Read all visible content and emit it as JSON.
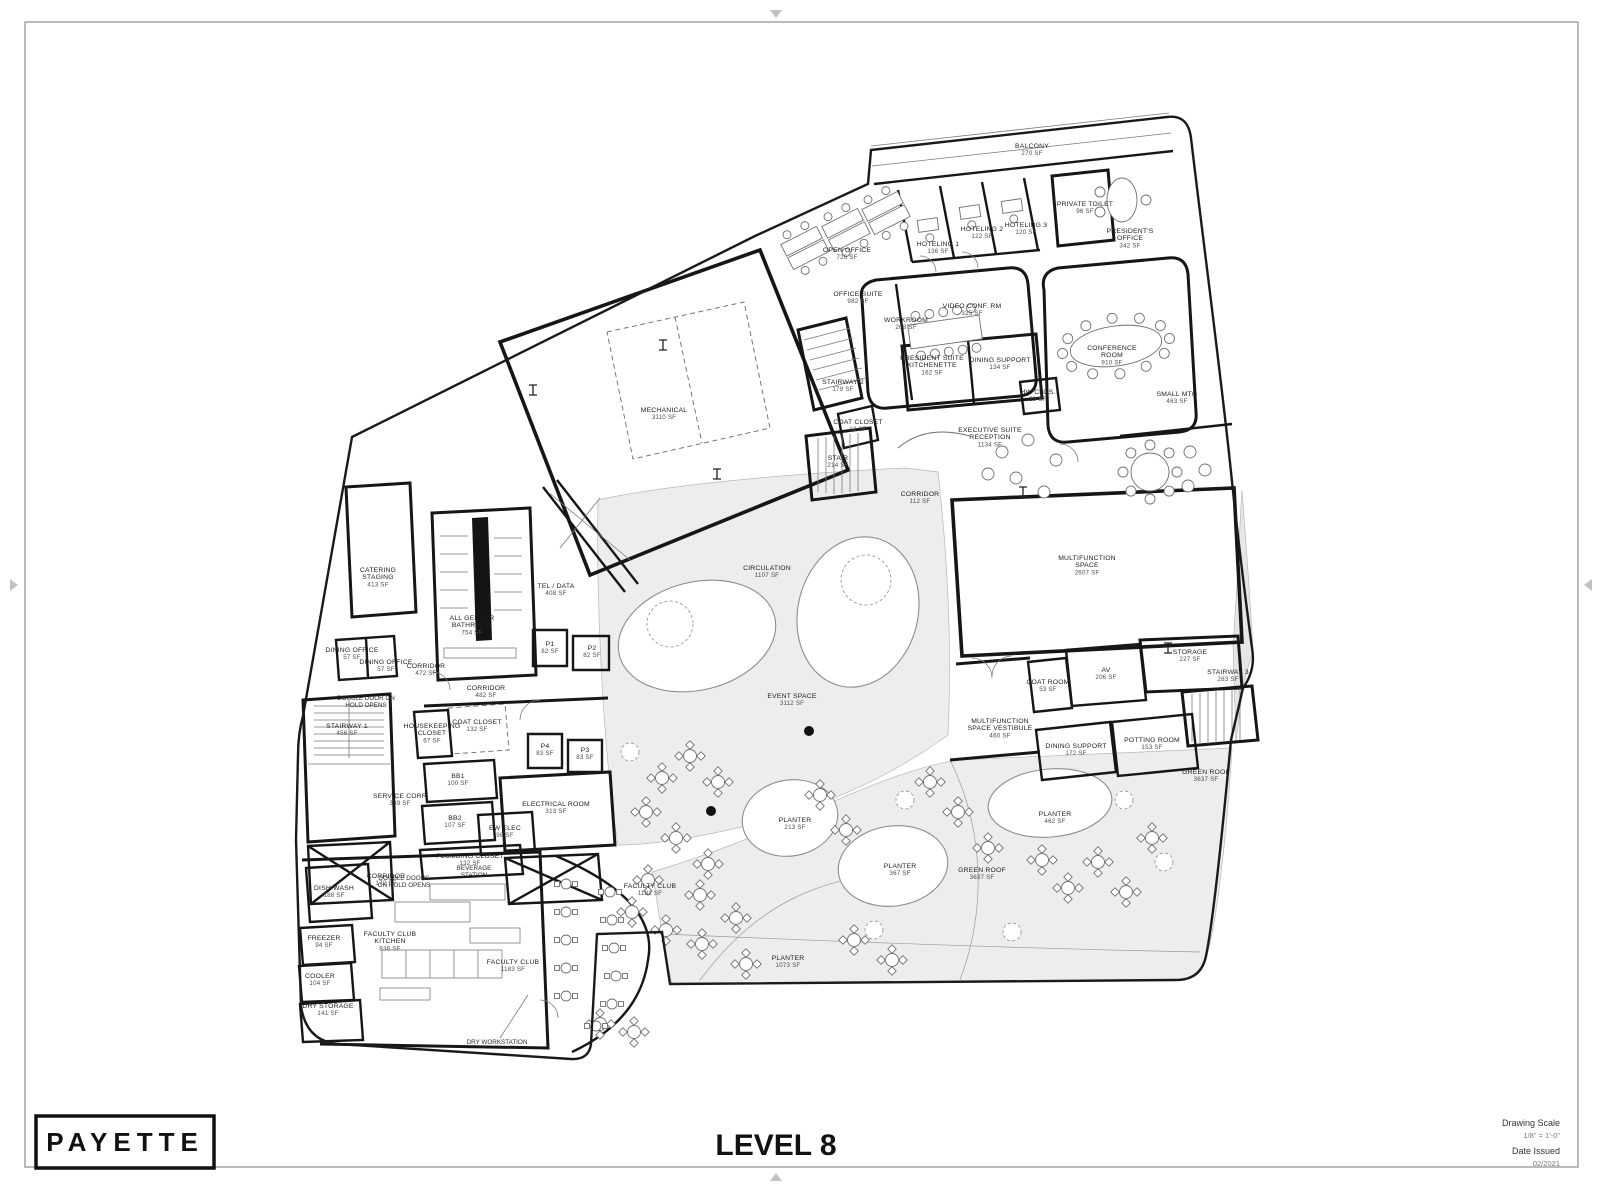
{
  "page": {
    "logo": "PAYETTE",
    "title": "LEVEL 8",
    "titleblock": {
      "drawing_scale_label": "Drawing Scale",
      "drawing_scale_value": "1/8\" = 1'-0\"",
      "date_issued_label": "Date Issued",
      "date_issued_value": "02/2021"
    }
  },
  "rooms": [
    {
      "lines": [
        "BALCONY"
      ],
      "sf": "270 SF",
      "x": 1032,
      "y": 148
    },
    {
      "lines": [
        "OPEN OFFICE"
      ],
      "sf": "726 SF",
      "x": 847,
      "y": 252
    },
    {
      "lines": [
        "HOTELING 1"
      ],
      "sf": "136 SF",
      "x": 938,
      "y": 246
    },
    {
      "lines": [
        "HOTELING 2"
      ],
      "sf": "122 SF",
      "x": 982,
      "y": 231
    },
    {
      "lines": [
        "HOTELING 3"
      ],
      "sf": "120 SF",
      "x": 1026,
      "y": 227
    },
    {
      "lines": [
        "PRIVATE TOILET"
      ],
      "sf": "96 SF",
      "x": 1085,
      "y": 206
    },
    {
      "lines": [
        "PRESIDENT'S",
        "OFFICE"
      ],
      "sf": "342 SF",
      "x": 1130,
      "y": 233
    },
    {
      "lines": [
        "OFFICE SUITE"
      ],
      "sf": "982 SF",
      "x": 858,
      "y": 296
    },
    {
      "lines": [
        "WORKROOM"
      ],
      "sf": "208 SF",
      "x": 906,
      "y": 322
    },
    {
      "lines": [
        "VIDEO CONF. RM"
      ],
      "sf": "325 SF",
      "x": 972,
      "y": 308
    },
    {
      "lines": [
        "CONFERENCE",
        "ROOM"
      ],
      "sf": "910 SF",
      "x": 1112,
      "y": 350
    },
    {
      "lines": [
        "PRESIDENT SUITE",
        "KITCHENETTE"
      ],
      "sf": "162 SF",
      "x": 932,
      "y": 360
    },
    {
      "lines": [
        "DINING SUPPORT"
      ],
      "sf": "134 SF",
      "x": 1000,
      "y": 362
    },
    {
      "lines": [
        "HW CLOS."
      ],
      "sf": "23 SF",
      "x": 1038,
      "y": 394
    },
    {
      "lines": [
        "SMALL MTG"
      ],
      "sf": "463 SF",
      "x": 1177,
      "y": 396
    },
    {
      "lines": [
        "STAIRWAY 2"
      ],
      "sf": "179 SF",
      "x": 843,
      "y": 384
    },
    {
      "lines": [
        "COAT CLOSET"
      ],
      "sf": "12 SF",
      "x": 858,
      "y": 424
    },
    {
      "lines": [
        "STAIR"
      ],
      "sf": "214 SF",
      "x": 838,
      "y": 460
    },
    {
      "lines": [
        "EXECUTIVE SUITE",
        "RECEPTION"
      ],
      "sf": "1134 SF",
      "x": 990,
      "y": 432
    },
    {
      "lines": [
        "MECHANICAL"
      ],
      "sf": "3110 SF",
      "x": 664,
      "y": 412
    },
    {
      "lines": [
        "CORRIDOR"
      ],
      "sf": "112 SF",
      "x": 920,
      "y": 496
    },
    {
      "lines": [
        "CIRCULATION"
      ],
      "sf": "1107 SF",
      "x": 767,
      "y": 570
    },
    {
      "lines": [
        "EVENT SPACE"
      ],
      "sf": "3112 SF",
      "x": 792,
      "y": 698
    },
    {
      "lines": [
        "MULTIFUNCTION",
        "SPACE"
      ],
      "sf": "2607 SF",
      "x": 1087,
      "y": 560
    },
    {
      "lines": [
        "STORAGE"
      ],
      "sf": "227 SF",
      "x": 1190,
      "y": 654
    },
    {
      "lines": [
        "AV"
      ],
      "sf": "206 SF",
      "x": 1106,
      "y": 672
    },
    {
      "lines": [
        "COAT ROOM"
      ],
      "sf": "53 SF",
      "x": 1048,
      "y": 684
    },
    {
      "lines": [
        "STAIRWAY 3"
      ],
      "sf": "283 SF",
      "x": 1228,
      "y": 674
    },
    {
      "lines": [
        "MULTIFUNCTION",
        "SPACE VESTIBULE"
      ],
      "sf": "460 SF",
      "x": 1000,
      "y": 723
    },
    {
      "lines": [
        "DINING SUPPORT"
      ],
      "sf": "172 SF",
      "x": 1076,
      "y": 748
    },
    {
      "lines": [
        "POTTING ROOM"
      ],
      "sf": "153 SF",
      "x": 1152,
      "y": 742
    },
    {
      "lines": [
        "GREEN ROOF"
      ],
      "sf": "3637 SF",
      "x": 1206,
      "y": 774
    },
    {
      "lines": [
        "PLANTER"
      ],
      "sf": "462 SF",
      "x": 1055,
      "y": 816
    },
    {
      "lines": [
        "PLANTER"
      ],
      "sf": "213 SF",
      "x": 795,
      "y": 822
    },
    {
      "lines": [
        "PLANTER"
      ],
      "sf": "367 SF",
      "x": 900,
      "y": 868
    },
    {
      "lines": [
        "GREEN ROOF"
      ],
      "sf": "3637 SF",
      "x": 982,
      "y": 872
    },
    {
      "lines": [
        "PLANTER"
      ],
      "sf": "1073 SF",
      "x": 788,
      "y": 960
    },
    {
      "lines": [
        "CATERING",
        "STAGING"
      ],
      "sf": "413 SF",
      "x": 378,
      "y": 572
    },
    {
      "lines": [
        "TEL / DATA"
      ],
      "sf": "408 SF",
      "x": 556,
      "y": 588
    },
    {
      "lines": [
        "ALL GENDER",
        "BATHROOM"
      ],
      "sf": "754 SF",
      "x": 472,
      "y": 620
    },
    {
      "lines": [
        "DINING OFFICE"
      ],
      "sf": "57 SF",
      "x": 352,
      "y": 652
    },
    {
      "lines": [
        "DINING OFFICE"
      ],
      "sf": "57 SF",
      "x": 386,
      "y": 664
    },
    {
      "lines": [
        "CORRIDOR"
      ],
      "sf": "472 SF",
      "x": 426,
      "y": 668
    },
    {
      "lines": [
        "P1"
      ],
      "sf": "82 SF",
      "x": 550,
      "y": 646
    },
    {
      "lines": [
        "P2"
      ],
      "sf": "82 SF",
      "x": 592,
      "y": 650
    },
    {
      "lines": [
        "CORRIDOR"
      ],
      "sf": "482 SF",
      "x": 486,
      "y": 690
    },
    {
      "lines": [
        "COAT CLOSET"
      ],
      "sf": "132 SF",
      "x": 477,
      "y": 724
    },
    {
      "lines": [
        "HOUSEKEEPING",
        "CLOSET"
      ],
      "sf": "67 SF",
      "x": 432,
      "y": 728
    },
    {
      "lines": [
        "STAIRWAY 1"
      ],
      "sf": "456 SF",
      "x": 347,
      "y": 728
    },
    {
      "lines": [
        "P4"
      ],
      "sf": "83 SF",
      "x": 545,
      "y": 748
    },
    {
      "lines": [
        "P3"
      ],
      "sf": "83 SF",
      "x": 585,
      "y": 752
    },
    {
      "lines": [
        "SERVICE CORR"
      ],
      "sf": "339 SF",
      "x": 400,
      "y": 798
    },
    {
      "lines": [
        "BB1"
      ],
      "sf": "100 SF",
      "x": 458,
      "y": 778
    },
    {
      "lines": [
        "BB2"
      ],
      "sf": "107 SF",
      "x": 455,
      "y": 820
    },
    {
      "lines": [
        "ELECTRICAL ROOM"
      ],
      "sf": "313 SF",
      "x": 556,
      "y": 806
    },
    {
      "lines": [
        "EW ELEC"
      ],
      "sf": "98 SF",
      "x": 505,
      "y": 830
    },
    {
      "lines": [
        "PLUMBING CLOSET"
      ],
      "sf": "132 SF",
      "x": 470,
      "y": 858
    },
    {
      "lines": [
        "CORRIDOR"
      ],
      "sf": "172 SF",
      "x": 386,
      "y": 878
    },
    {
      "lines": [
        "DISH WASH"
      ],
      "sf": "188 SF",
      "x": 334,
      "y": 890
    },
    {
      "lines": [
        "FREEZER"
      ],
      "sf": "94 SF",
      "x": 324,
      "y": 940
    },
    {
      "lines": [
        "FACULTY CLUB",
        "KITCHEN"
      ],
      "sf": "836 SF",
      "x": 390,
      "y": 936
    },
    {
      "lines": [
        "COOLER"
      ],
      "sf": "104 SF",
      "x": 320,
      "y": 978
    },
    {
      "lines": [
        "DRY STORAGE"
      ],
      "sf": "141 SF",
      "x": 328,
      "y": 1008
    },
    {
      "lines": [
        "FACULTY CLUB"
      ],
      "sf": "1183 SF",
      "x": 513,
      "y": 964
    },
    {
      "lines": [
        "FACULTY CLUB"
      ],
      "sf": "1181 SF",
      "x": 650,
      "y": 888
    }
  ],
  "annotations": [
    {
      "lines": [
        "DOUBLE DOOR ON",
        "HOLD OPENS"
      ],
      "x": 366,
      "y": 700
    },
    {
      "lines": [
        "DOUBLE DOORS",
        "ON HOLD OPENS"
      ],
      "x": 404,
      "y": 880
    },
    {
      "lines": [
        "BEVERAGE",
        "STATION"
      ],
      "x": 474,
      "y": 870
    },
    {
      "lines": [
        "DRY WORKSTATION"
      ],
      "x": 497,
      "y": 1044
    }
  ]
}
